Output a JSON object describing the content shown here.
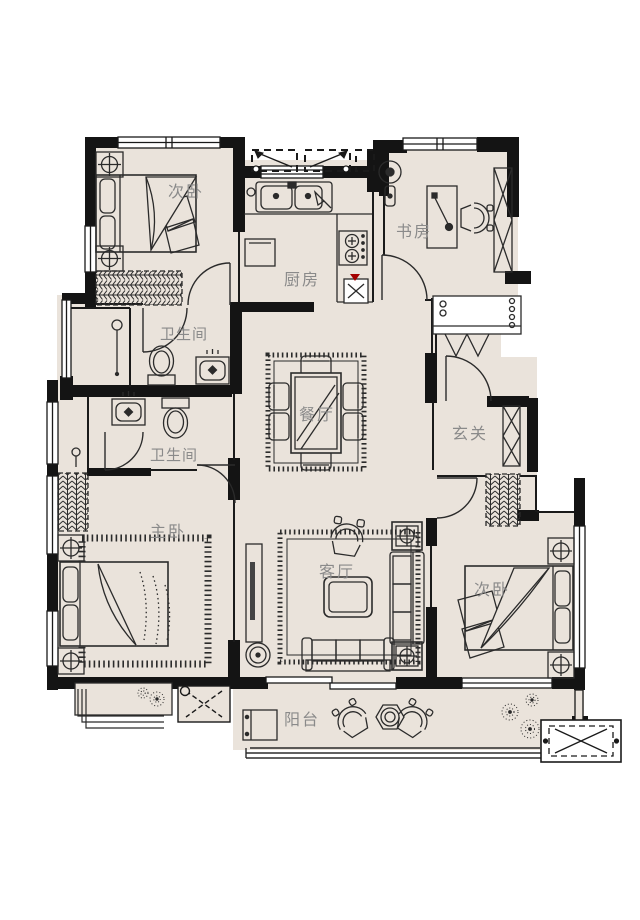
{
  "title": "apartment-floor-plan",
  "colors": {
    "background": "#FFFFFF",
    "floor": "#EAE3DB",
    "wall": "#141414",
    "line": "#2B2B2B",
    "label": "#8A8A8A",
    "accent_red": "#A40000"
  },
  "rooms": [
    {
      "id": "bedroom-top-left",
      "label": "次卧"
    },
    {
      "id": "kitchen",
      "label": "厨房"
    },
    {
      "id": "study",
      "label": "书房"
    },
    {
      "id": "bathroom-upper",
      "label": "卫生间"
    },
    {
      "id": "bathroom-lower",
      "label": "卫生间"
    },
    {
      "id": "dining-room",
      "label": "餐厅"
    },
    {
      "id": "foyer",
      "label": "玄关"
    },
    {
      "id": "master-bedroom",
      "label": "主卧"
    },
    {
      "id": "living-room",
      "label": "客厅"
    },
    {
      "id": "bedroom-bottom-right",
      "label": "次卧"
    },
    {
      "id": "balcony",
      "label": "阳台"
    }
  ]
}
